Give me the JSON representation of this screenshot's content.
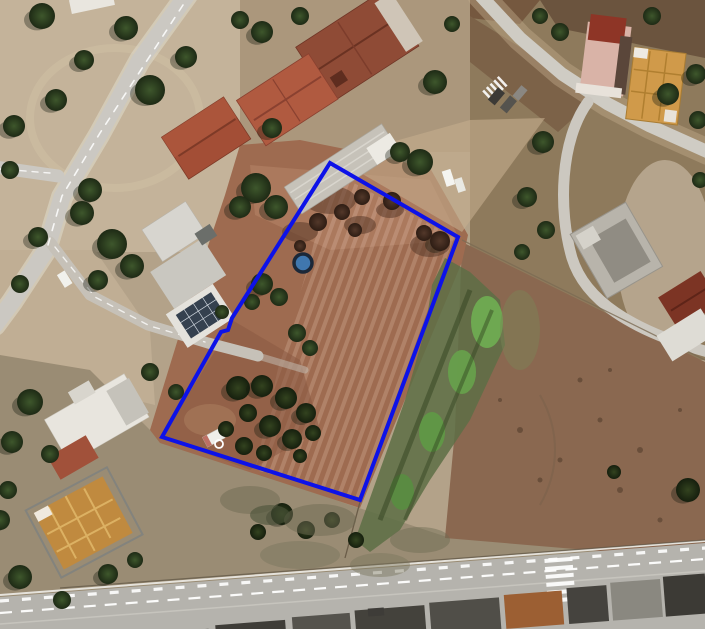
{
  "view": {
    "kind": "satellite-aerial-imagery",
    "width": 705,
    "height": 629
  },
  "parcel": {
    "boundary_points": "330,163 458,237 360,500 162,437 221,332 228,330 232,318",
    "outline_color": "#0d12e8",
    "outline_width": "4"
  },
  "markers": {
    "parcel_dot": {
      "cx": "303",
      "cy": "263",
      "r": "9",
      "fill": "#4077ae",
      "ring_color": "#1c2838",
      "ring_width": "3.5"
    },
    "small_ring": {
      "cx": "219",
      "cy": "444",
      "r": "4",
      "stroke": "#ffffff",
      "stroke_width": "1.8"
    }
  },
  "palette": {
    "field_red": "#9e6b50",
    "field_pale": "#c4b39a",
    "dirt_dark": "#6b543e",
    "scrub": "#9a8c74",
    "se_field": "#8a6850",
    "road_gray": "#cbc8c2",
    "highway_gray": "#b5b3ad",
    "vegetation_dark": "#2c3a22",
    "vegetation_bright": "#6fae52",
    "roof_red": "#a34e36",
    "roof_brown": "#8f4b36",
    "roof_orange": "#c08a3f",
    "building_white": "#e6e3dc",
    "marking_white": "#ffffff"
  }
}
